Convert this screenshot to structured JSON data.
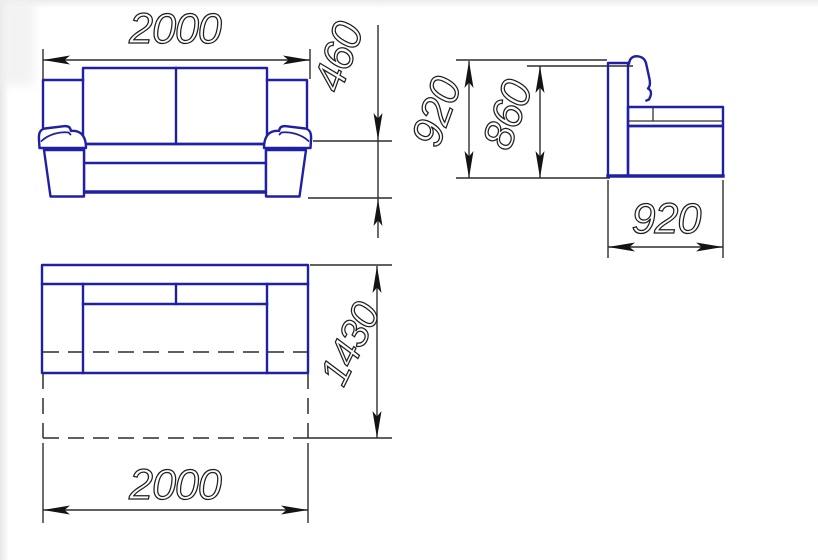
{
  "drawing": {
    "colors": {
      "furniture_outline": "#2020a4",
      "dimension_lines": "#2d2d2d",
      "background": "#ffffff"
    },
    "front_view": {
      "width_mm": "2000",
      "seat_height_mm": "460"
    },
    "side_view": {
      "overall_height_mm": "920",
      "backrest_height_mm": "860",
      "depth_mm": "920"
    },
    "top_view": {
      "width_mm": "2000",
      "depth_unfolded_mm": "1430"
    }
  }
}
